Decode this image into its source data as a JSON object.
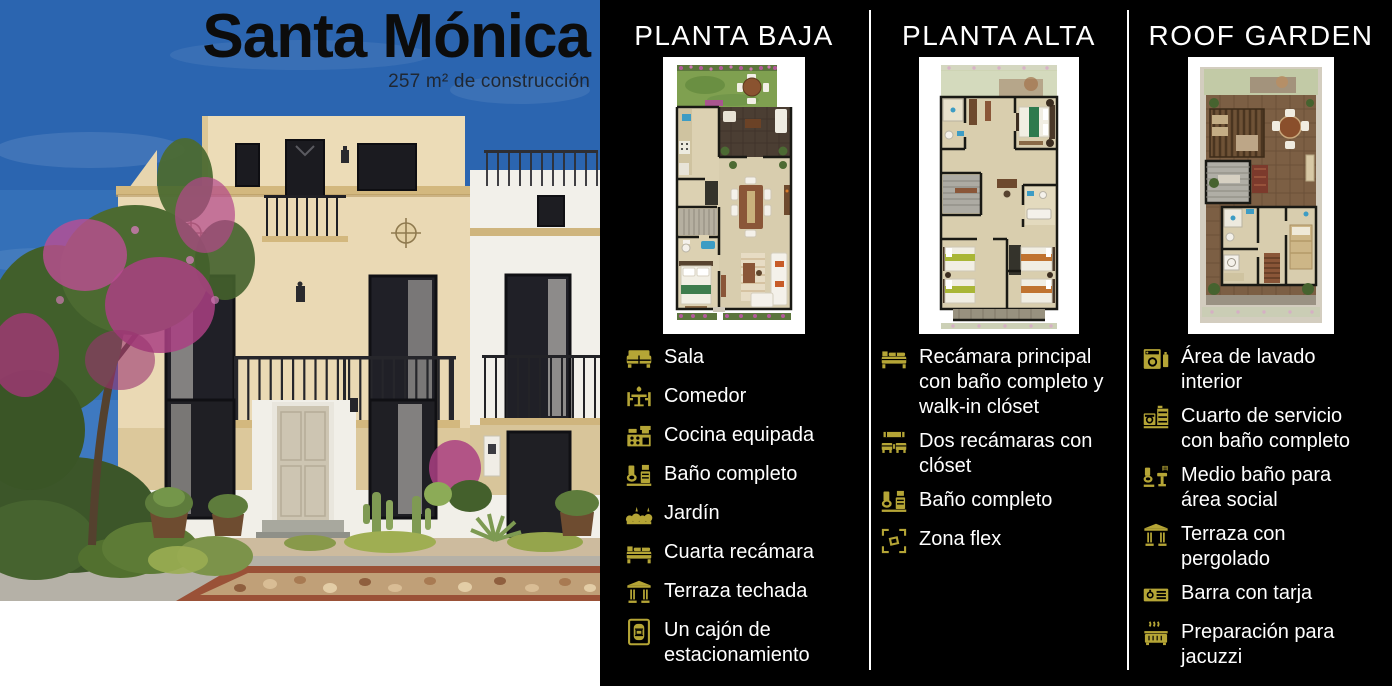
{
  "title": "Santa Mónica",
  "subtitle": "257 m² de construcción",
  "colors": {
    "accent_gold": "#b5a536",
    "panel_background": "#000000",
    "divider": "#ffffff",
    "feature_text": "#ffffff",
    "title_text": "#0c0c0c",
    "sky_blue": "#3470b8",
    "facade_beige": "#ead9b4"
  },
  "columns": [
    {
      "header": "PLANTA BAJA",
      "floorplan": "planta-baja-floorplan",
      "features": [
        {
          "icon": "sofa-icon",
          "label": "Sala"
        },
        {
          "icon": "dining-table-icon",
          "label": "Comedor"
        },
        {
          "icon": "kitchen-icon",
          "label": "Cocina equipada"
        },
        {
          "icon": "bathroom-icon",
          "label": "Baño completo"
        },
        {
          "icon": "garden-icon",
          "label": "Jardín"
        },
        {
          "icon": "bed-icon",
          "label": "Cuarta recámara"
        },
        {
          "icon": "pergola-icon",
          "label": "Terraza techada"
        },
        {
          "icon": "car-parking-icon",
          "label": "Un cajón de estacionamiento"
        }
      ]
    },
    {
      "header": "PLANTA ALTA",
      "floorplan": "planta-alta-floorplan",
      "features": [
        {
          "icon": "bed-icon",
          "label": "Recámara principal con baño completo y walk-in clóset"
        },
        {
          "icon": "two-beds-icon",
          "label": "Dos recámaras con clóset"
        },
        {
          "icon": "bathroom-icon",
          "label": "Baño completo"
        },
        {
          "icon": "flex-zone-icon",
          "label": "Zona flex"
        }
      ]
    },
    {
      "header": "ROOF GARDEN",
      "floorplan": "roof-garden-floorplan",
      "features": [
        {
          "icon": "laundry-icon",
          "label": "Área de lavado interior"
        },
        {
          "icon": "service-room-icon",
          "label": "Cuarto de servicio con baño completo"
        },
        {
          "icon": "half-bath-icon",
          "label": "Medio baño para área social"
        },
        {
          "icon": "pergola-icon",
          "label": "Terraza con pergolado"
        },
        {
          "icon": "bar-sink-icon",
          "label": "Barra con tarja"
        },
        {
          "icon": "jacuzzi-icon",
          "label": "Preparación para jacuzzi"
        }
      ]
    }
  ]
}
